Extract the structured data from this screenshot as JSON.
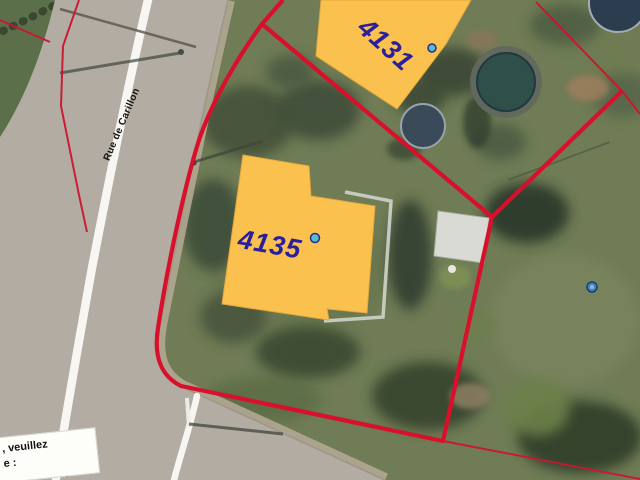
{
  "map": {
    "view": "aerial-parcel-map",
    "street_label_left": "Rue de Carillon",
    "street_label_bottom": "des Sa",
    "clipped_overlay": {
      "line1": ", veuillez",
      "line2": "e :"
    },
    "parcels": [
      {
        "address": "4131"
      },
      {
        "address": "4135"
      }
    ],
    "markers": [
      {
        "name": "building-marker-4131",
        "color": "#55BECE"
      },
      {
        "name": "building-marker-4135",
        "color": "#55BECE"
      },
      {
        "name": "poi-marker-blue",
        "color": "#3E86C6"
      }
    ],
    "colors": {
      "parcel_boundary_red": "#D8102C",
      "neighbor_boundary_red": "#CC1630",
      "building_fill": "#FBC14E",
      "address_label": "#2A1F9C",
      "road": "#B2ACA3",
      "road_line_white": "#F7F6F2",
      "grass": "#6F7C55"
    }
  }
}
